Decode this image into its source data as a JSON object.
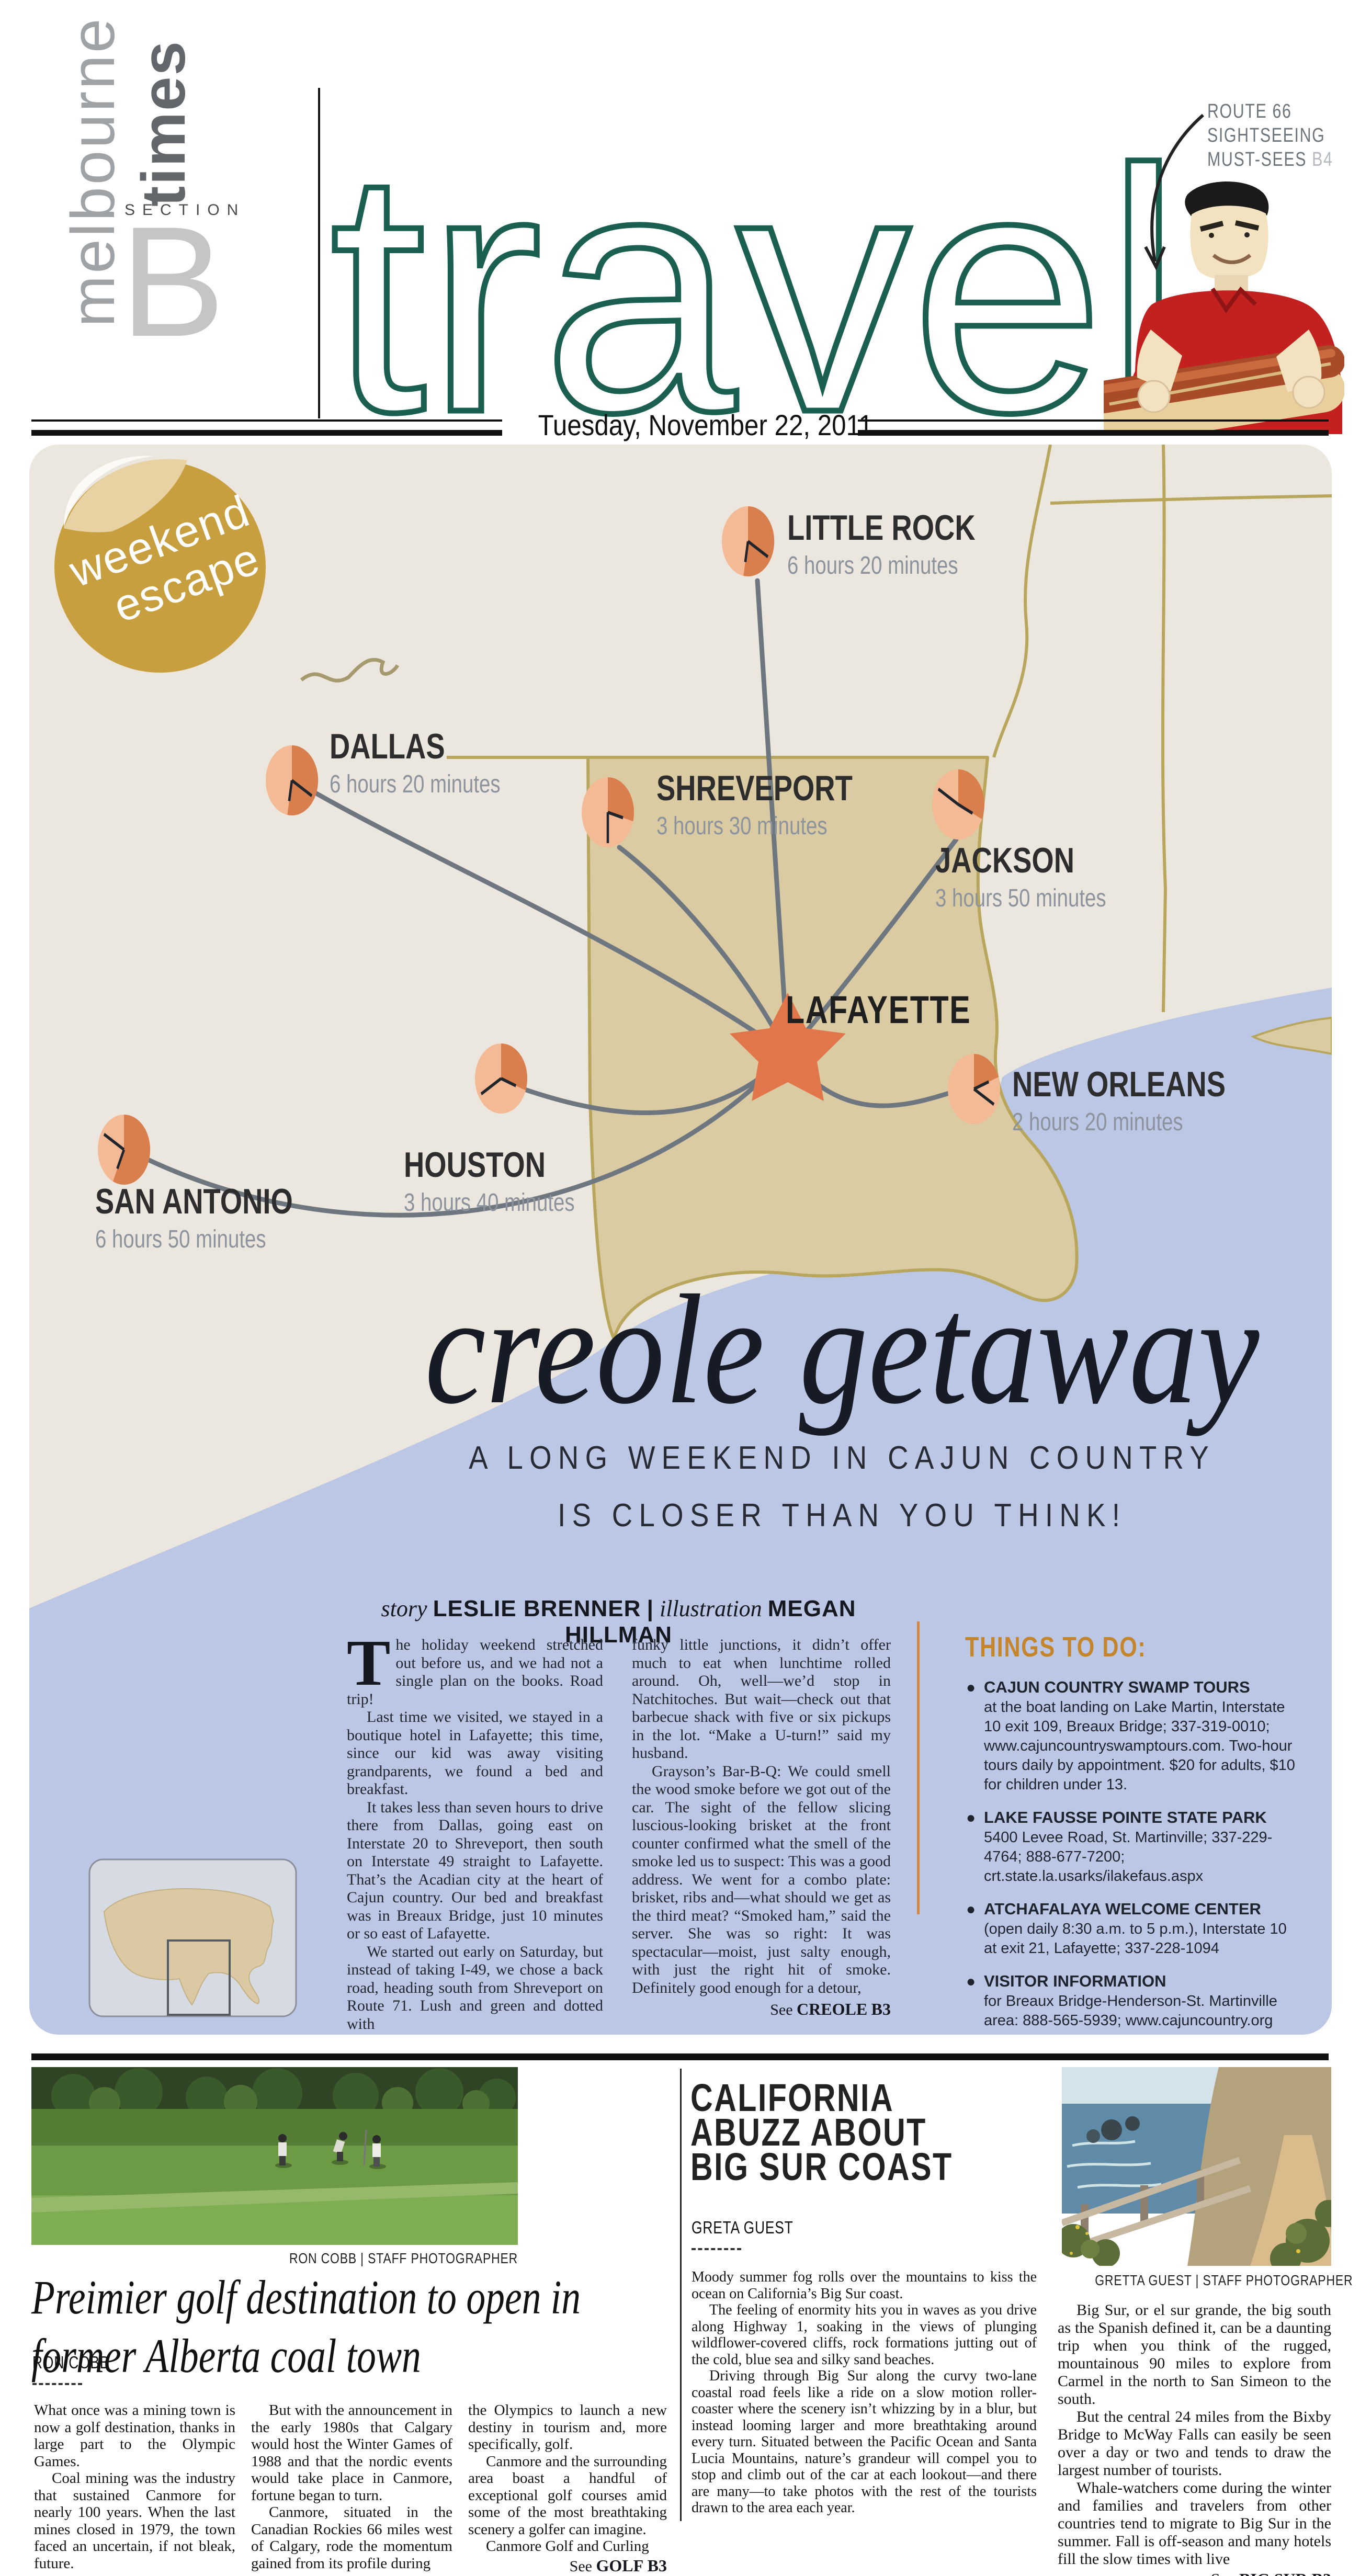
{
  "masthead": {
    "paper_name": "melbourne",
    "paper_suffix": "times",
    "section_label": "SECTION",
    "section_letter": "B",
    "title": "travel",
    "teaser": {
      "line1": "ROUTE 66",
      "line2": "SIGHTSEEING",
      "line3": "MUST-SEES",
      "page": "B4"
    },
    "date": "Tuesday, November 22, 2011"
  },
  "sticker": {
    "line1": "weekend",
    "line2": "escape"
  },
  "map": {
    "destination": "LAFAYETTE",
    "cities": [
      {
        "name": "LITTLE ROCK",
        "time": "6 hours 20 minutes",
        "clock": "6:20"
      },
      {
        "name": "DALLAS",
        "time": "6 hours 20 minutes",
        "clock": "6:20"
      },
      {
        "name": "SHREVEPORT",
        "time": "3 hours 30 minutes",
        "clock": "3:30"
      },
      {
        "name": "JACKSON",
        "time": "3 hours 50 minutes",
        "clock": "3:50"
      },
      {
        "name": "NEW ORLEANS",
        "time": "2 hours 20 minutes",
        "clock": "2:20"
      },
      {
        "name": "HOUSTON",
        "time": "3 hours 40 minutes",
        "clock": "3:40"
      },
      {
        "name": "SAN ANTONIO",
        "time": "6 hours 50 minutes",
        "clock": "6:50"
      }
    ]
  },
  "feature": {
    "headline": "creole getaway",
    "subtitle_line1": "A LONG WEEKEND IN CAJUN COUNTRY",
    "subtitle_line2": "IS CLOSER THAN YOU THINK!",
    "byline": {
      "story_label": "story",
      "story_name": "LESLIE BRENNER",
      "sep": "|",
      "illustration_label": "illustration",
      "illustration_name": "MEGAN HILLMAN"
    },
    "dropcap": "T",
    "col1": {
      "p1": "he holiday weekend stretched out before us, and we had not a single plan on the books. Road trip!",
      "p2": "Last time we visited, we stayed in a boutique hotel in Lafayette; this time, since our kid was away visiting grandparents, we found a bed and breakfast.",
      "p3": "It takes less than seven hours to drive there from Dallas, going east on Interstate 20 to Shreveport, then south on Interstate 49 straight to Lafayette. That’s the Acadian city at the heart of Cajun country. Our bed and breakfast was in Breaux Bridge, just 10 minutes or so east of Lafayette.",
      "p4": "We started out early on Saturday, but instead of taking I-49, we chose a back road, heading south from Shreveport on Route 71. Lush and green and dotted with"
    },
    "col2": {
      "p1": "funky little junctions, it didn’t offer much to eat when lunchtime rolled around. Oh, well—we’d stop in Natchitoches. But wait—check out that barbecue shack with five or six pickups in the lot. “Make a U-turn!” said my husband.",
      "p2": "Grayson’s Bar-B-Q: We could smell the wood smoke before we got out of the car. The sight of the fellow slicing luscious-looking brisket at the front counter confirmed what the smell of the smoke led us to suspect: This was a good address. We went for a combo plate: brisket, ribs and—what should we get as the third meat? “Smoked ham,” said the server. She was so right: It was spectacular—moist, just salty enough, with just the right hit of smoke. Definitely good enough for a detour,"
    },
    "continued": {
      "see": "See",
      "ref": "CREOLE",
      "page": "B3"
    }
  },
  "things_to_do": {
    "heading": "THINGS TO DO:",
    "items": [
      {
        "title": "CAJUN COUNTRY SWAMP TOURS",
        "body": "at the boat landing on Lake Martin, Interstate 10 exit 109, Breaux Bridge; 337-319-0010; www.cajuncountryswamptours.com. Two-hour tours daily by appointment. $20 for adults, $10 for children under 13."
      },
      {
        "title": "LAKE FAUSSE POINTE STATE PARK",
        "body": "5400 Levee Road, St. Martinville; 337-229-4764; 888-677-7200; crt.state.la.usarks/ilakefaus.aspx"
      },
      {
        "title": "ATCHAFALAYA WELCOME CENTER",
        "body": "(open daily 8:30 a.m. to 5 p.m.), Interstate 10 at exit 21, Lafayette; 337-228-1094"
      },
      {
        "title": "VISITOR INFORMATION",
        "body": "for Breaux Bridge-Henderson-St. Martinville area: 888-565-5939; www.cajuncountry.org"
      }
    ]
  },
  "golf": {
    "photo_credit": "RON COBB | STAFF PHOTOGRAPHER",
    "headline_line1": "Preimier golf destination to open in",
    "headline_line2": "former Alberta coal town",
    "byline": "RON COBB",
    "col1": {
      "p1": "What once was a mining town is now a golf destination, thanks in large part to the Olympic Games.",
      "p2": "Coal mining was the industry that sustained Canmore for nearly 100 years. When the last mines closed in 1979, the town faced an uncertain, if not bleak, future."
    },
    "col2": {
      "p1": "But with the announcement in the early 1980s that Calgary would host the Winter Games of 1988 and that the nordic events would take place in Canmore, fortune began to turn.",
      "p2": "Canmore, situated in the Canadian Rockies 66 miles west of Calgary, rode the momentum gained from its profile during"
    },
    "col3": {
      "p1": "the Olympics to launch a new destiny in tourism and, more specifically, golf.",
      "p2": "Canmore and the surrounding area boast a handful of exceptional golf courses amid some of the most breathtaking scenery a golfer can imagine.",
      "p3": "Canmore Golf and Curling"
    },
    "continued": {
      "see": "See",
      "ref": "GOLF",
      "page": "B3"
    }
  },
  "bigsur": {
    "headline_line1": "CALIFORNIA",
    "headline_line2": "ABUZZ ABOUT",
    "headline_line3": "BIG SUR COAST",
    "byline": "GRETA GUEST",
    "col1": {
      "p1": "Moody summer fog rolls over the mountains to kiss the ocean on California’s Big Sur coast.",
      "p2": "The feeling of enormity hits you in waves as you drive along Highway 1, soaking in the views of plunging wildflower-covered cliffs, rock formations jutting out of the cold, blue sea and silky sand beaches.",
      "p3": "Driving through Big Sur along the curvy two-lane coastal road feels like a ride on a slow motion roller-coaster where the scenery isn’t whizzing by in a blur, but instead looming larger and more breathtaking around every turn. Situated between the Pacific Ocean and Santa Lucia Mountains, nature’s grandeur will compel you to stop and climb out of the car at each lookout—and there are many—to take photos with the rest of the tourists drawn to the area each year."
    },
    "photo_credit": "GRETTA GUEST | STAFF PHOTOGRAPHER",
    "col2": {
      "p1": "Big Sur, or el sur grande, the big south as the Spanish defined it, can be a daunting trip when you think of the rugged, mountainous 90 miles to explore from Carmel in the north to San Simeon to the south.",
      "p2": "But the central 24 miles from the Bixby Bridge to McWay Falls can easily be seen over a day or two and tends to draw the largest number of tourists.",
      "p3": "Whale-watchers come during the winter and families and travelers from other countries tend to migrate to Big Sur in the summer. Fall is off-season and many hotels fill the slow times with live"
    },
    "continued": {
      "see": "See",
      "ref": "BIG SUR",
      "page": "B3"
    }
  }
}
